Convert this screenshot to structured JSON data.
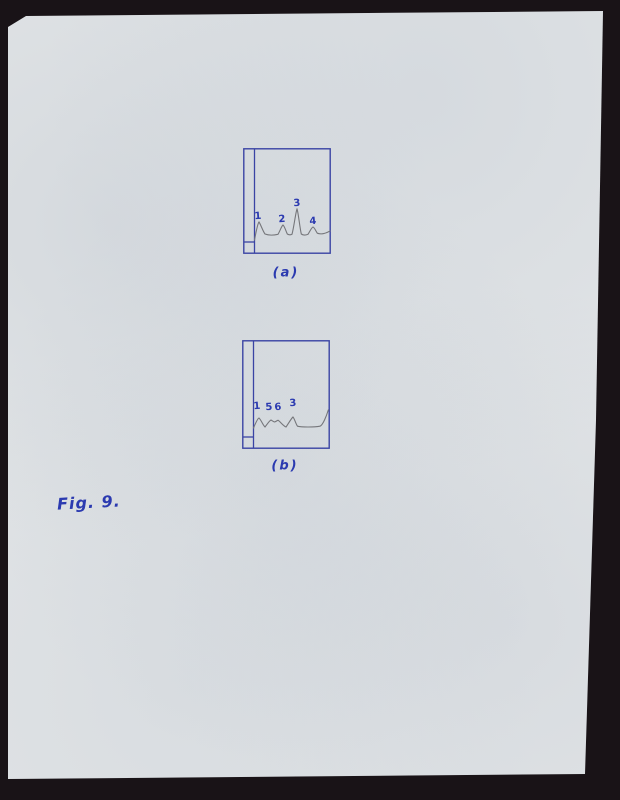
{
  "document": {
    "figure_label": "Fig. 9.",
    "figures": [
      {
        "caption": "(a)",
        "peaks": [
          "1",
          "2",
          "3",
          "4"
        ]
      },
      {
        "caption": "(b)",
        "peaks": [
          "1",
          "5",
          "6",
          "3"
        ]
      }
    ]
  },
  "colors": {
    "ink_blue": "#2b3ab0",
    "box_blue": "#3a44a4",
    "trace_gray": "#75767a",
    "paper": "#e1e4e6",
    "scanner_background": "#191317"
  }
}
